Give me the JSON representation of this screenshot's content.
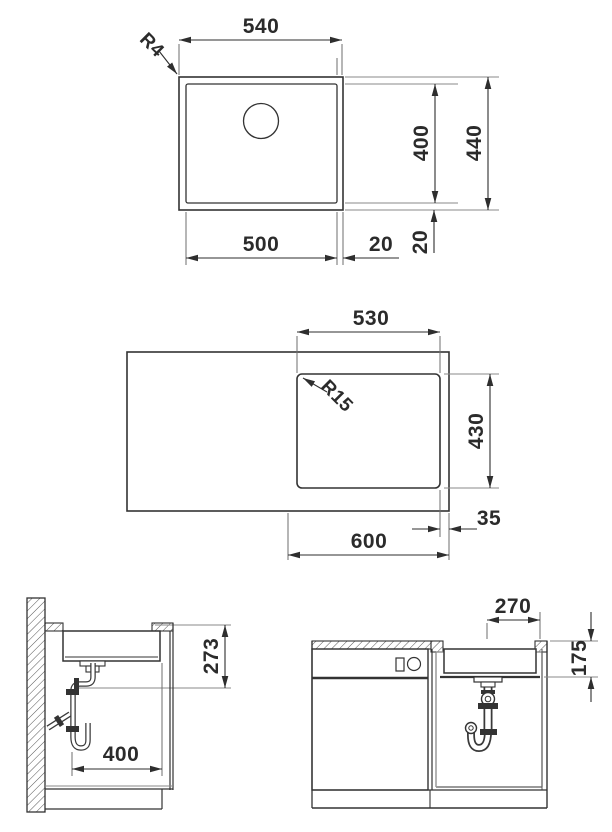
{
  "title": "Sink installation technical drawing",
  "plan": {
    "width": "540",
    "corner_radius": "R4",
    "bowl_depth": "400",
    "overall_depth": "440",
    "bowl_width": "500",
    "gap_right": "20",
    "gap_bottom": "20"
  },
  "cutout": {
    "width": "530",
    "corner_radius": "R15",
    "depth": "430",
    "edge_offset": "35",
    "cabinet_width": "600"
  },
  "side": {
    "drain_height": "273",
    "bowl_depth": "400"
  },
  "front": {
    "drain_offset": "270",
    "bowl_height": "175"
  },
  "colors": {
    "line": "#333333",
    "dimension": "#2e2e2e",
    "extension": "#6e6e6e",
    "background": "#ffffff"
  }
}
